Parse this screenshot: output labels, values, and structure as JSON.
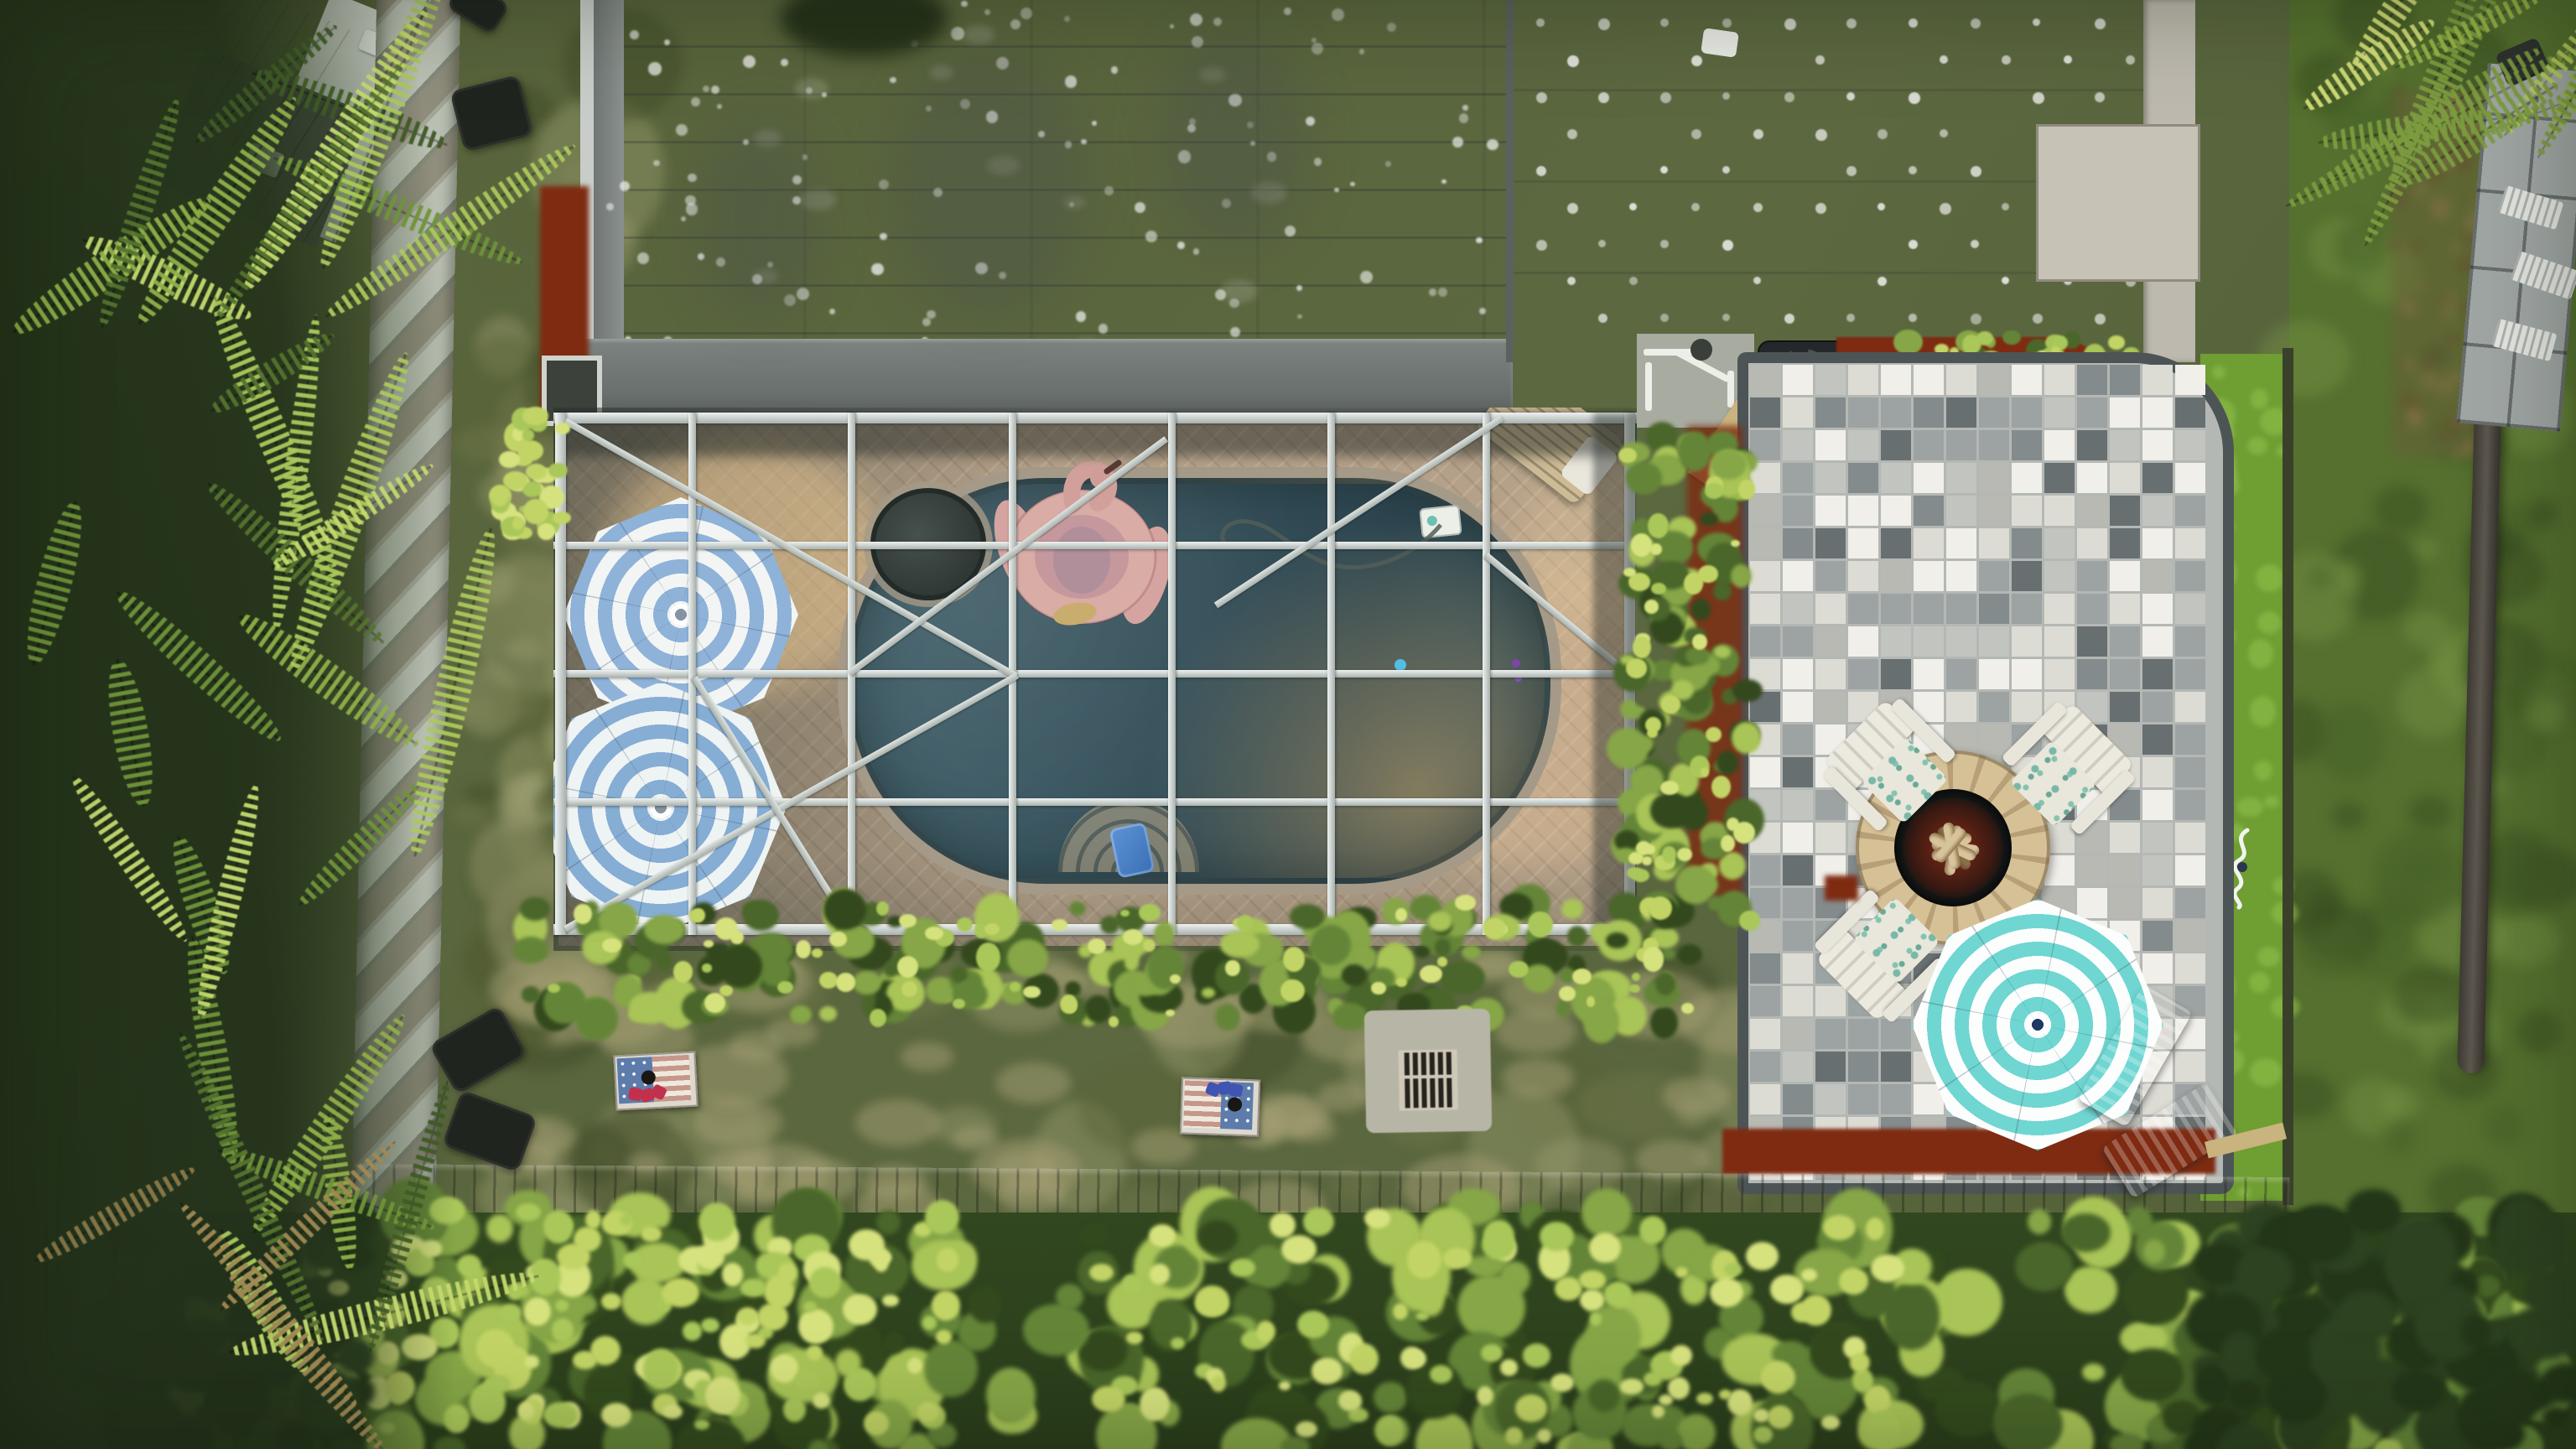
{
  "scene": {
    "description": "Daytime aerial drone photo of a backyard: screened pool enclosure with oval pool, pink flamingo float and two blue striped umbrellas, gray speckled house roof, checkered paver patio with stone fire pit, white Adirondack chairs and a teal striped umbrella, lawn with US-flag cornhole boards, palm trees, hedges and fences",
    "view": "top-down aerial"
  },
  "palette": {
    "grass": "#5a663c",
    "turf": "#6f9e33",
    "roof_gray": "#a3a8a5",
    "roof_eave": "#6a706d",
    "deck_tan": "#b5a189",
    "pool_teal": "#35505a",
    "frame_white": "#eef2f0",
    "umbrella_blue": "#8fb2d8",
    "umbrella_teal": "#6fd6d2",
    "flamingo_pink": "#d9aca6",
    "mulch_red": "#7e2b12",
    "patio_border": "#4d5456",
    "fire_stone": "#d6c096",
    "chair_white": "#e9e7db",
    "fence_wood": "#a5a796",
    "hedge_green": "#648538"
  },
  "objects": {
    "roof": {
      "label": "Gray speckled house roof"
    },
    "roof_flat": {
      "label": "Flat roof section with vent-dot grid"
    },
    "enclosure": {
      "label": "Screened pool enclosure (lanai)"
    },
    "pool": {
      "label": "Swimming pool"
    },
    "spa": {
      "label": "Dark round spa at pool end"
    },
    "flamingo": {
      "label": "Pink flamingo pool float"
    },
    "umbrella_blue_top": {
      "label": "Blue and white striped umbrella inside enclosure"
    },
    "umbrella_blue_bottom": {
      "label": "Blue and white striped umbrella inside enclosure"
    },
    "umbrella_teal": {
      "label": "Teal and white striped umbrella on patio"
    },
    "deck_lounger": {
      "label": "Slatted lounge chair on pool deck"
    },
    "pool_steps": {
      "label": "Curved pool entry steps"
    },
    "blue_chair": {
      "label": "Blue child seat at pool steps"
    },
    "skimmer": {
      "label": "Pool skimmer box at pool edge"
    },
    "hose": {
      "label": "Pool cleaner hose on deck"
    },
    "patio": {
      "label": "Gray checkered paver patio"
    },
    "fire_pit": {
      "label": "Stone fire pit with logs"
    },
    "adirondack": {
      "label": "White Adirondack chair with floral cushion"
    },
    "gray_lounger": {
      "label": "Gray sun lounger"
    },
    "grill": {
      "label": "Black grill beside the house"
    },
    "red_item": {
      "label": "Red object beside grill"
    },
    "pool_equipment": {
      "label": "Pool equipment with white PVC pipes"
    },
    "cornhole_red": {
      "label": "US flag cornhole board with red bean bags"
    },
    "cornhole_blue": {
      "label": "US flag cornhole board with blue bean bags"
    },
    "drain": {
      "label": "Square yard drain grate"
    },
    "black_chair": {
      "label": "Black chair on the lawn"
    },
    "fence": {
      "label": "Wooden privacy fence"
    },
    "boardwalk": {
      "label": "Wooden fence cap along back of yard"
    },
    "hedge": {
      "label": "Trimmed hedge along enclosure"
    },
    "bottom_foliage": {
      "label": "Trees and shrubs along the bottom"
    },
    "palms_left": {
      "label": "Palm trees along left fence"
    },
    "palms_tr": {
      "label": "Palm fronds at top right"
    },
    "turf": {
      "label": "Bright artificial turf strip"
    },
    "turf_sign": {
      "label": "White script lawn sign"
    },
    "neighbor_lawn": {
      "label": "Neighboring lawn"
    },
    "neighbor_patio": {
      "label": "Neighbor screened patio with loungers"
    },
    "shed": {
      "label": "Neighbor shed roof"
    },
    "mulch": {
      "label": "Red mulch landscape bed"
    },
    "trunk": {
      "label": "Palm trunk along right boundary"
    }
  },
  "decor": {
    "patio_tile_colors": [
      "#f0efe9",
      "#f0efe9",
      "#dddcd4",
      "#dddcd4",
      "#c2c4bf",
      "#9da3a2",
      "#9da3a2",
      "#848b8c",
      "#686f71",
      "#b7b9b2"
    ],
    "hedge_colors": [
      "#33491d",
      "#4a662a",
      "#648538",
      "#86a647",
      "#a9c457"
    ],
    "hedge_bright_colors": [
      "#c2d465",
      "#d6e27e",
      "#aac75a"
    ],
    "hedge_dark_colors": [
      "#243618",
      "#2d4220"
    ],
    "palm_colors": [
      "#3f5a26",
      "#55742e",
      "#6f943a",
      "#8fb048",
      "#abc95c",
      "#c4da6e"
    ],
    "palm_brown": [
      "#a08a54",
      "#8a7a4a"
    ],
    "palm_tr_colors": [
      "#9ab648",
      "#b8cc5e",
      "#d5de7a",
      "#7d9c40"
    ],
    "grass_patch_colors": [
      "rgba(148,148,105,.5)",
      "rgba(110,117,73,.45)",
      "rgba(64,76,40,.5)",
      "rgba(158,160,112,.4)",
      "rgba(90,99,56,.5)"
    ],
    "dry_patch_color": "rgba(165,160,115,.5)",
    "turf_mottle": "rgba(150,200,80,.5)",
    "litter_color": "rgba(100,80,50,.55)",
    "speckle_color": "255,255,255"
  }
}
